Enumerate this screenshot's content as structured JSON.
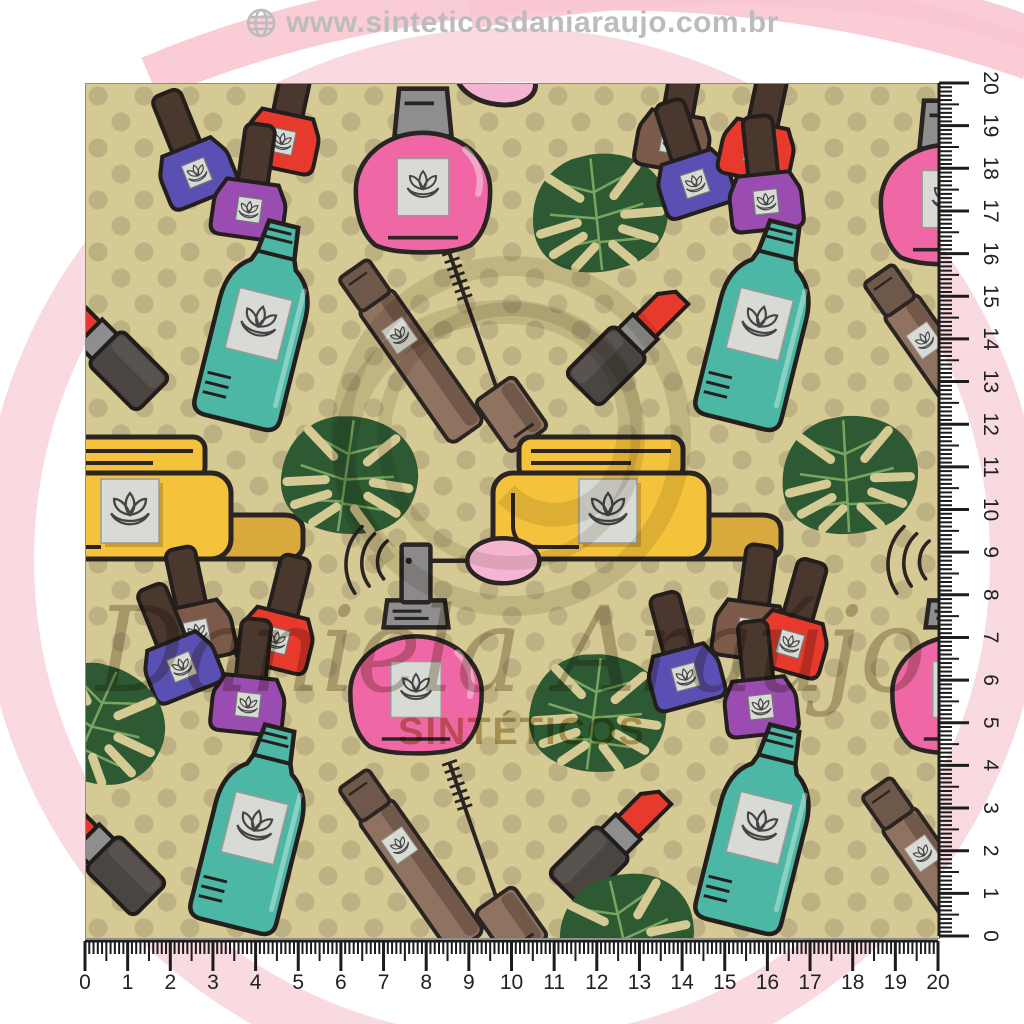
{
  "header": {
    "url_text": "www.sinteticosdaniaraujo.com.br",
    "globe_icon": "globe-icon"
  },
  "watermark": {
    "script_text": "Daniela Araújo",
    "caps_text": "SINTÉTICOS"
  },
  "rulers": {
    "bottom_labels": [
      "0",
      "1",
      "2",
      "3",
      "4",
      "5",
      "6",
      "7",
      "8",
      "9",
      "10",
      "11",
      "12",
      "13",
      "14",
      "15",
      "16",
      "17",
      "18",
      "19",
      "20"
    ],
    "right_labels": [
      "20",
      "19",
      "18",
      "17",
      "16",
      "15",
      "14",
      "13",
      "12",
      "11",
      "10",
      "9",
      "8",
      "7",
      "6",
      "5",
      "4",
      "3",
      "2",
      "1",
      "0"
    ]
  },
  "pattern": {
    "background_color": "#d5c994",
    "dot_color": "#bdb184",
    "colors": {
      "pink": "#ef68a5",
      "violet": "#5a50b4",
      "red": "#e73a2c",
      "purple": "#9b4cb0",
      "brown": "#7b5a49",
      "teal": "#4cb7a4",
      "yellow": "#f5c33b",
      "green": "#2e5a33",
      "bulb_pink": "#f5b5d2"
    },
    "items": [
      {
        "name": "perfume-flask",
        "color": "#ef68a5"
      },
      {
        "name": "perfume-atomizer",
        "color": "#ef68a5"
      },
      {
        "name": "nail-polish-violet",
        "color": "#5a50b4"
      },
      {
        "name": "nail-polish-red",
        "color": "#e73a2c"
      },
      {
        "name": "nail-polish-purple",
        "color": "#9b4cb0"
      },
      {
        "name": "nail-polish-brown",
        "color": "#7b5a49"
      },
      {
        "name": "lotion-bottle",
        "color": "#4cb7a4"
      },
      {
        "name": "mascara",
        "color": "#8f7260"
      },
      {
        "name": "lipstick",
        "color": "#e8482d"
      },
      {
        "name": "cream-jar",
        "color": "#f5c33b"
      },
      {
        "name": "monstera-leaf",
        "color": "#2e5a33"
      }
    ]
  },
  "decor": {
    "ring_color": "#f8d3da",
    "swoosh_color": "#f8c6d1"
  }
}
